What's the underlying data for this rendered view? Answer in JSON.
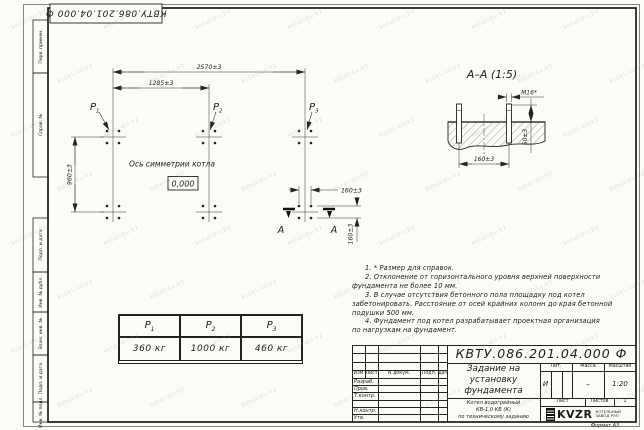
{
  "doc_code": "КВТУ.086.201.04.000  Ф",
  "margin_labels": {
    "top": [
      "Перв. примен.",
      "Справ. №"
    ],
    "bottom": [
      "Подп. и дата",
      "Инв. № дубл.",
      "Взам. инв. №",
      "Подп. и дата",
      "Инв. № подл."
    ]
  },
  "plan": {
    "dim_width_total": "2570±3",
    "dim_width_half": "1285±3",
    "dim_depth": "960±3",
    "dim_bolt_h": "160±3",
    "dim_bolt_v": "160±3",
    "load_p1": "P",
    "load_p1_sub": "1",
    "load_p2": "P",
    "load_p2_sub": "2",
    "load_p3": "P",
    "load_p3_sub": "3",
    "axis_label": "Ось симметрии котла",
    "elevation_mark": "0,000",
    "section_letter_left": "А",
    "section_letter_right": "А"
  },
  "section_view": {
    "title": "А–А  (1:5)",
    "thread_label": "М16*",
    "dim_spacing": "160±3",
    "dim_protrusion": "50±3"
  },
  "load_table": {
    "headers": [
      {
        "sym": "P",
        "sub": "1"
      },
      {
        "sym": "P",
        "sub": "2"
      },
      {
        "sym": "P",
        "sub": "3"
      }
    ],
    "values": [
      "360 кг",
      "1000 кг",
      "460 кг"
    ]
  },
  "notes_lines": [
    "1. * Размер для справок.",
    "2. Отклонение от горизонтального уровня верхней поверхности",
    "фундамента не более 10 мм.",
    "3. В случае отсутствия бетонного пола площадку под котел",
    "забетонировать. Расстояние от осей крайних колонн до края бетонной",
    "подушки 500 мм.",
    "4. Фундамент под котел разрабатывает проектная организация",
    "по нагрузкам на фундамент."
  ],
  "title_block": {
    "code": "КВТУ.086.201.04.000  Ф",
    "title_lines": [
      "Задание на",
      "установку",
      "фундамента"
    ],
    "subtitle_lines": [
      "Котел водогрейный",
      "КВ-1,0 КБ (К)",
      "по техническому заданию"
    ],
    "header_cols": [
      "Изм",
      "Лист",
      "N докум.",
      "Подп.",
      "Дата"
    ],
    "row_labels": [
      "Разраб.",
      "Пров.",
      "Т.контр.",
      "Н.контр.",
      "Утв."
    ],
    "lit_header": "Лит.",
    "mass_header": "Масса",
    "scale_header": "Масштаб",
    "lit_value": "И",
    "mass_value": "–",
    "scale_value": "1:20",
    "sheet_label": "Лист",
    "sheets_label": "Листов",
    "sheets_value": "1",
    "logo_text": "KVZR",
    "logo_caption": [
      "КОТЕЛЬНЫЙ",
      "ЗАВОД РЭП"
    ],
    "format_label": "Формат А3"
  },
  "watermark_text": "kotel-kv.kz"
}
